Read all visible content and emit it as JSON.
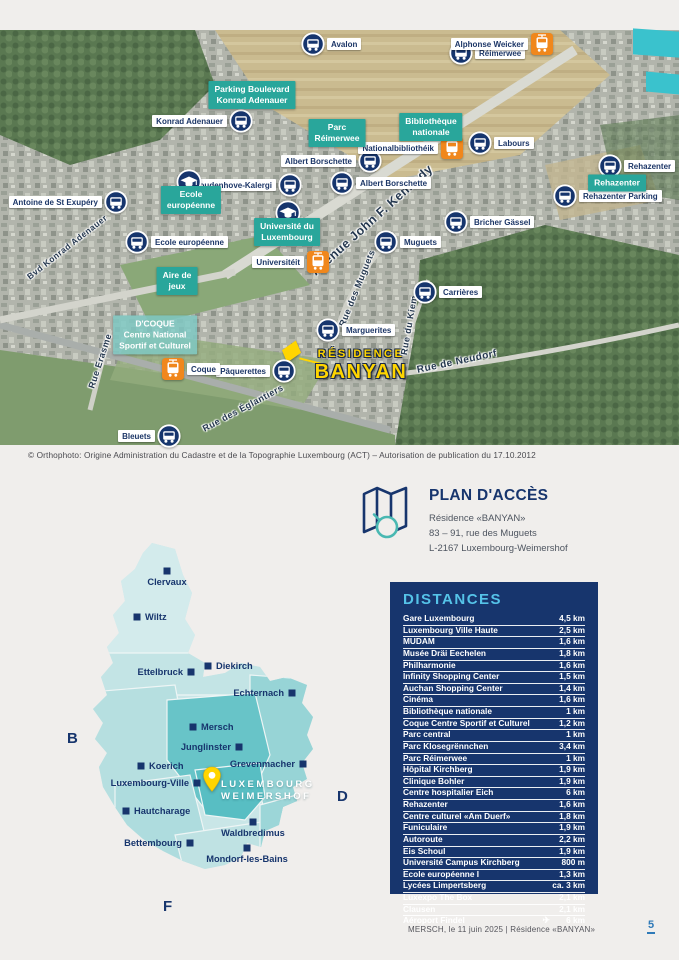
{
  "colors": {
    "teal": "#29a69b",
    "navy": "#17356d",
    "orange": "#f0871c",
    "yellow": "#ffd500",
    "accent_blue": "#55c3e8",
    "page_bg": "#f0eeec",
    "cyan_highlight": "#3ac2cd"
  },
  "aerial": {
    "credit": "© Orthophoto: Origine Administration du Cadastre et de la Topographie Luxembourg (ACT) – Autorisation de publication du 17.10.2012",
    "residence": {
      "line1": "RÉSIDENCE",
      "line2": "BANYAN"
    },
    "bus_stops": [
      {
        "name": "Avalon",
        "x": 313,
        "y": 14,
        "side": "right"
      },
      {
        "name": "Réimerwee",
        "x": 461,
        "y": 23,
        "side": "right"
      },
      {
        "name": "Konrad Adenauer",
        "x": 241,
        "y": 91,
        "side": "left"
      },
      {
        "name": "Albert Borschette",
        "x": 370,
        "y": 131,
        "side": "left"
      },
      {
        "name": "Albert Borschette",
        "x": 342,
        "y": 153,
        "side": "right"
      },
      {
        "name": "Coudenhove-Kalergi",
        "x": 290,
        "y": 155,
        "side": "left"
      },
      {
        "name": "Labours",
        "x": 480,
        "y": 113,
        "side": "right"
      },
      {
        "name": "Rehazenter",
        "x": 610,
        "y": 136,
        "side": "right"
      },
      {
        "name": "Rehazenter Parking",
        "x": 565,
        "y": 166,
        "side": "right"
      },
      {
        "name": "Antoine de St Exupéry",
        "x": 116,
        "y": 172,
        "side": "left"
      },
      {
        "name": "Ecole européenne",
        "x": 137,
        "y": 212,
        "side": "right"
      },
      {
        "name": "Muguets",
        "x": 386,
        "y": 212,
        "side": "right"
      },
      {
        "name": "Bricher Gässel",
        "x": 456,
        "y": 192,
        "side": "right"
      },
      {
        "name": "Carrières",
        "x": 425,
        "y": 262,
        "side": "right"
      },
      {
        "name": "Marguerites",
        "x": 328,
        "y": 300,
        "side": "right"
      },
      {
        "name": "Pâquerettes",
        "x": 284,
        "y": 341,
        "side": "left"
      },
      {
        "name": "Bleuets",
        "x": 169,
        "y": 406,
        "side": "left"
      }
    ],
    "tram_stops": [
      {
        "name": "Alphonse Weicker",
        "x": 542,
        "y": 14,
        "side": "left"
      },
      {
        "name": "Nationalbibliothéik",
        "x": 452,
        "y": 118,
        "side": "left"
      },
      {
        "name": "Universitéit",
        "x": 318,
        "y": 232,
        "side": "left"
      },
      {
        "name": "Coque",
        "x": 173,
        "y": 339,
        "side": "right"
      }
    ],
    "school_icons": [
      {
        "x": 189,
        "y": 152
      },
      {
        "x": 288,
        "y": 183
      }
    ],
    "poi_boxes": [
      {
        "lines": [
          "Parking Boulevard",
          "Konrad Adenauer"
        ],
        "x": 252,
        "y": 65,
        "variant": "solid"
      },
      {
        "lines": [
          "Parc",
          "Réimerwee"
        ],
        "x": 337,
        "y": 103,
        "variant": "solid"
      },
      {
        "lines": [
          "Bibliothèque",
          "nationale"
        ],
        "x": 431,
        "y": 97,
        "variant": "solid"
      },
      {
        "lines": [
          "Ecole",
          "européenne"
        ],
        "x": 191,
        "y": 170,
        "variant": "solid"
      },
      {
        "lines": [
          "Université du",
          "Luxembourg"
        ],
        "x": 287,
        "y": 202,
        "variant": "solid"
      },
      {
        "lines": [
          "Aire de",
          "jeux"
        ],
        "x": 177,
        "y": 251,
        "variant": "solid"
      },
      {
        "lines": [
          "Rehazenter"
        ],
        "x": 617,
        "y": 153,
        "variant": "solid"
      },
      {
        "lines": [
          "D'COQUE",
          "Centre National",
          "Sportif et Culturel"
        ],
        "x": 155,
        "y": 305,
        "variant": "light"
      }
    ],
    "streets": [
      {
        "name": "Bvd Konrad Adenauer",
        "x": 67,
        "y": 217,
        "angle": -38,
        "size": 8.5
      },
      {
        "name": "Avenue John F. Kennedy",
        "x": 372,
        "y": 190,
        "angle": -42,
        "size": 12.5
      },
      {
        "name": "Rue des Muguets",
        "x": 357,
        "y": 258,
        "angle": -68,
        "size": 9
      },
      {
        "name": "Rue du Kiem",
        "x": 409,
        "y": 295,
        "angle": -80,
        "size": 9
      },
      {
        "name": "Rue de Neudorf",
        "x": 457,
        "y": 332,
        "angle": -12,
        "size": 10
      },
      {
        "name": "Rue Erasme",
        "x": 100,
        "y": 331,
        "angle": -72,
        "size": 9
      },
      {
        "name": "Rue des Églantiers",
        "x": 243,
        "y": 378,
        "angle": -28,
        "size": 9
      }
    ]
  },
  "access": {
    "title": "PLAN D'ACCÈS",
    "lines": [
      "Résidence «BANYAN»",
      "83 – 91, rue des Muguets",
      "L-2167 Luxembourg-Weimershof"
    ]
  },
  "distances": {
    "title": "DISTANCES",
    "rows": [
      {
        "name": "Gare Luxembourg",
        "value": "4,5 km"
      },
      {
        "name": "Luxembourg Ville Haute",
        "value": "2,5 km"
      },
      {
        "name": "MUDAM",
        "value": "1,6 km"
      },
      {
        "name": "Musée Dräi Eechelen",
        "value": "1,8 km"
      },
      {
        "name": "Philharmonie",
        "value": "1,6 km"
      },
      {
        "name": "Infinity Shopping Center",
        "value": "1,5 km"
      },
      {
        "name": "Auchan Shopping Center",
        "value": "1,4 km"
      },
      {
        "name": "Cinéma",
        "value": "1,6 km"
      },
      {
        "name": "Bibliothèque nationale",
        "value": "1 km"
      },
      {
        "name": "Coque Centre Sportif et Culturel",
        "value": "1,2 km"
      },
      {
        "name": "Parc central",
        "value": "1 km"
      },
      {
        "name": "Parc Klosegrënnchen",
        "value": "3,4 km"
      },
      {
        "name": "Parc Réimerwee",
        "value": "1 km"
      },
      {
        "name": "Hôpital Kirchberg",
        "value": "1,9 km"
      },
      {
        "name": "Clinique Bohler",
        "value": "1,9 km"
      },
      {
        "name": "Centre hospitalier Eich",
        "value": "6 km"
      },
      {
        "name": "Rehazenter",
        "value": "1,6 km"
      },
      {
        "name": "Centre culturel «Am Duerf»",
        "value": "1,8 km"
      },
      {
        "name": "Funiculaire",
        "value": "1,9 km"
      },
      {
        "name": "Autoroute",
        "value": "2,2 km"
      },
      {
        "name": "Eis Schoul",
        "value": "1,9 km"
      },
      {
        "name": "Université Campus Kirchberg",
        "value": "800 m"
      },
      {
        "name": "Ecole européenne I",
        "value": "1,3 km"
      },
      {
        "name": "Lycées Limpertsberg",
        "value": "ca. 3 km"
      },
      {
        "name": "Luxexpo The Box",
        "value": "2,1 km"
      },
      {
        "name": "Clausen",
        "value": "2,1 km"
      },
      {
        "name": "Aéroport Findel",
        "value": "6 km",
        "icon": "plane-icon",
        "icon_glyph": "✈"
      }
    ]
  },
  "country_map": {
    "cities": [
      {
        "name": "Clervaux",
        "x": 112,
        "y": 36,
        "side": "below"
      },
      {
        "name": "Wiltz",
        "x": 82,
        "y": 82,
        "side": "right"
      },
      {
        "name": "Ettelbruck",
        "x": 136,
        "y": 137,
        "side": "left"
      },
      {
        "name": "Diekirch",
        "x": 153,
        "y": 131,
        "side": "right"
      },
      {
        "name": "Echternach",
        "x": 237,
        "y": 158,
        "side": "left"
      },
      {
        "name": "Mersch",
        "x": 138,
        "y": 192,
        "side": "right"
      },
      {
        "name": "Junglinster",
        "x": 184,
        "y": 212,
        "side": "left"
      },
      {
        "name": "Koerich",
        "x": 86,
        "y": 231,
        "side": "right"
      },
      {
        "name": "Grevenmacher",
        "x": 248,
        "y": 229,
        "side": "left"
      },
      {
        "name": "Luxembourg-Ville",
        "x": 142,
        "y": 248,
        "side": "left"
      },
      {
        "name": "Hautcharage",
        "x": 71,
        "y": 276,
        "side": "right"
      },
      {
        "name": "Waldbredimus",
        "x": 198,
        "y": 287,
        "side": "below"
      },
      {
        "name": "Bettembourg",
        "x": 135,
        "y": 308,
        "side": "left"
      },
      {
        "name": "Mondorf-les-Bains",
        "x": 192,
        "y": 313,
        "side": "below"
      }
    ],
    "highlight": {
      "line1": "LUXEMBOURG",
      "line2": "WEIMERSHOF"
    },
    "letters": [
      {
        "text": "B",
        "x": 12,
        "y": 195
      },
      {
        "text": "D",
        "x": 282,
        "y": 253
      },
      {
        "text": "F",
        "x": 108,
        "y": 363
      }
    ]
  },
  "footer": {
    "text": "MERSCH, le 11 juin 2025  |  Résidence «BANYAN»",
    "page_number": "5"
  }
}
